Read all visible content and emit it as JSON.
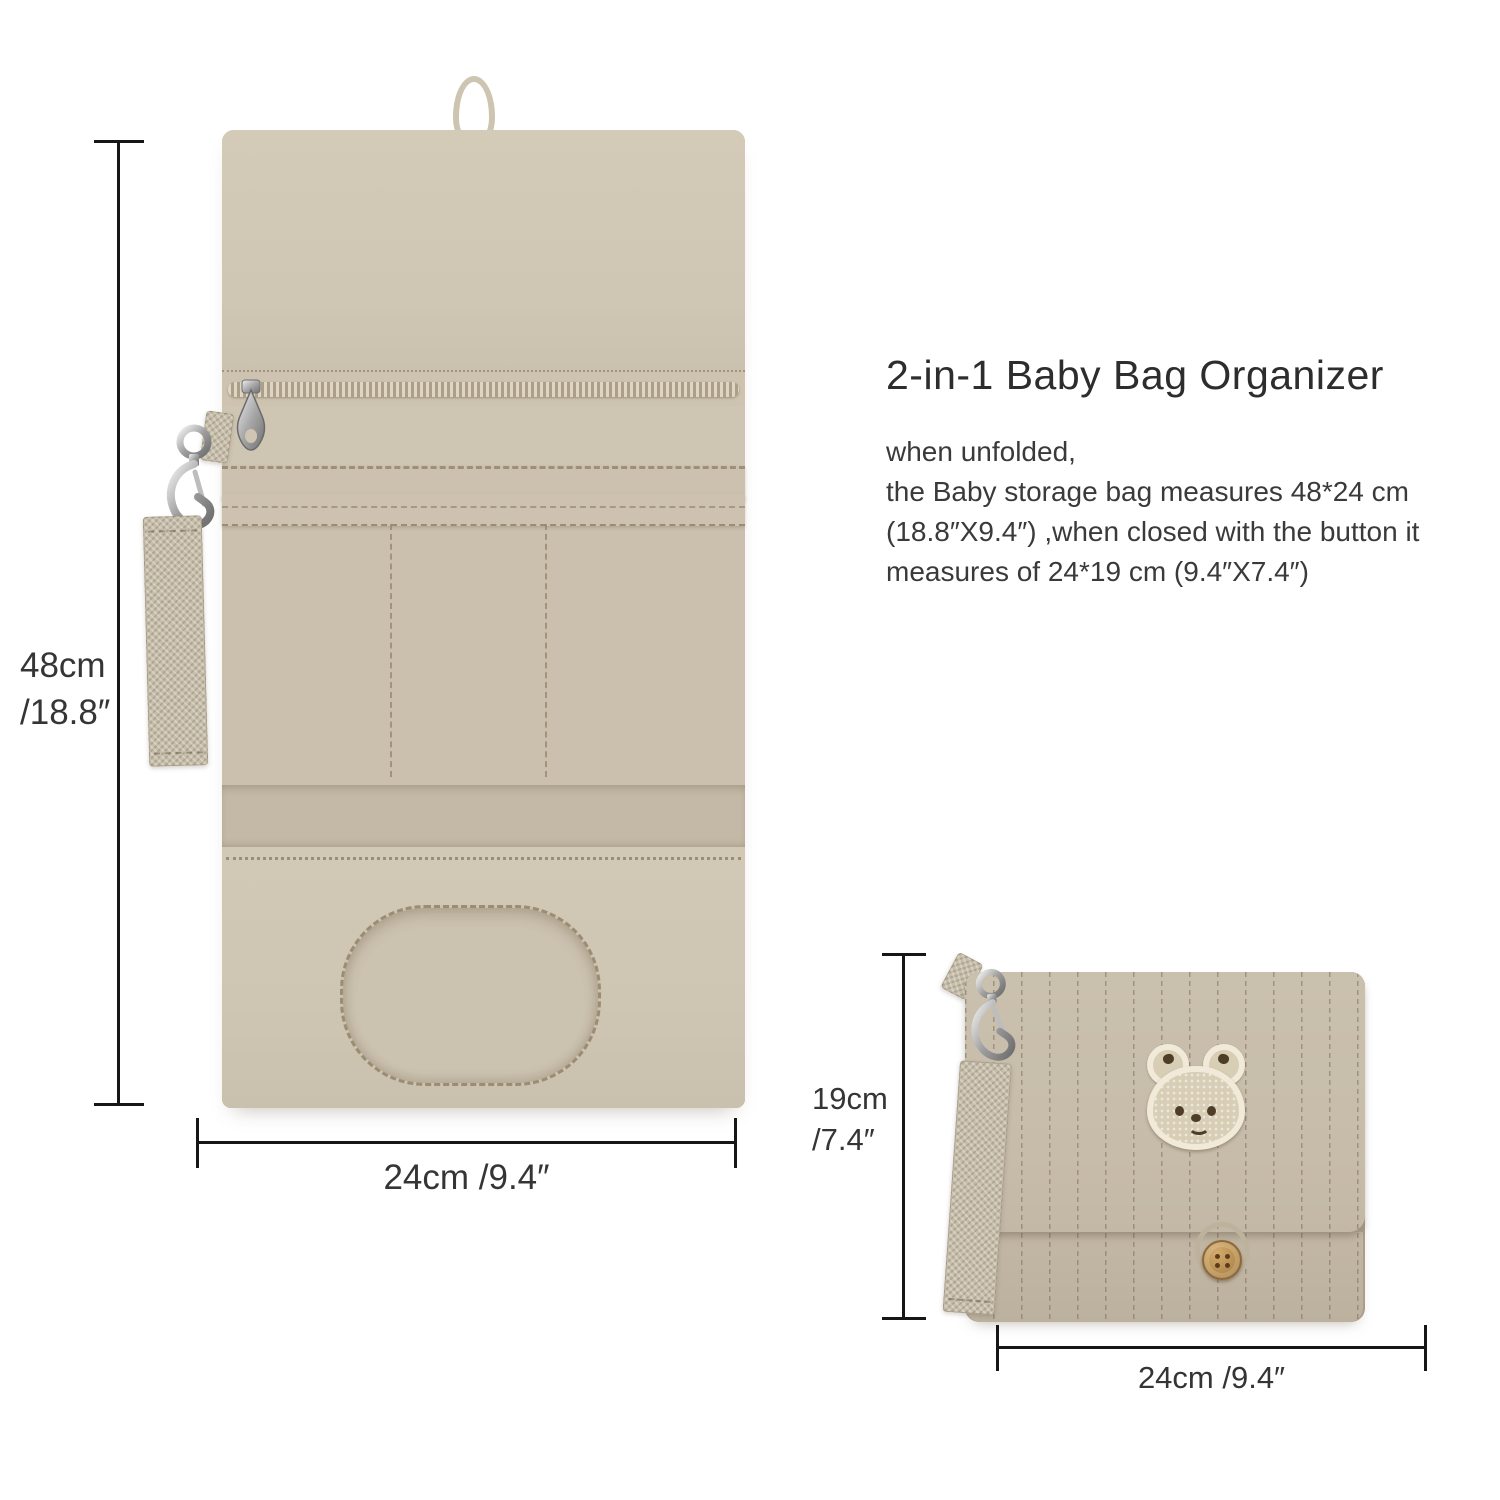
{
  "info_panel": {
    "title": "2-in-1 Baby Bag Organizer",
    "line1": "when unfolded,",
    "line2": "the Baby storage bag measures 48*24 cm",
    "line3": "(18.8″X9.4″) ,when closed with the button it",
    "line4": "measures of 24*19 cm  (9.4″X7.4″)"
  },
  "unfolded_bag": {
    "description": "unfolded baby storage bag interior with zipper pocket, slot pockets and wipes opening",
    "height_label_cm": "48cm",
    "height_label_in": "/18.8″",
    "width_label": "24cm /9.4″"
  },
  "folded_bag": {
    "description": "folded quilted baby bag with bear patch, wooden button and wrist strap",
    "height_label_cm": "19cm",
    "height_label_in": "/7.4″",
    "width_label": "24cm /9.4″"
  },
  "icons": {
    "carabiner_clip": "metal swivel snap hook",
    "zipper_pull": "metal teardrop zipper slider",
    "bear_patch": "embroidered bear face patch",
    "wooden_button": "round wooden 4-hole button",
    "hang_loop": "fabric hanging loop"
  },
  "colors": {
    "background": "#ffffff",
    "fabric_light": "#d1c7b5",
    "fabric_mid": "#cac0ad",
    "fabric_dark": "#c2b7a5",
    "stitch": "#a3967c",
    "webbing": "#c7beaa",
    "metal": "#9c9c9c",
    "patch_border": "#f2ead9",
    "patch_face": "#d8cdb5",
    "patch_feature": "#4e3d27",
    "button_wood": "#b98e50",
    "dimension_line": "#161616",
    "text": "#3a3a3a"
  }
}
